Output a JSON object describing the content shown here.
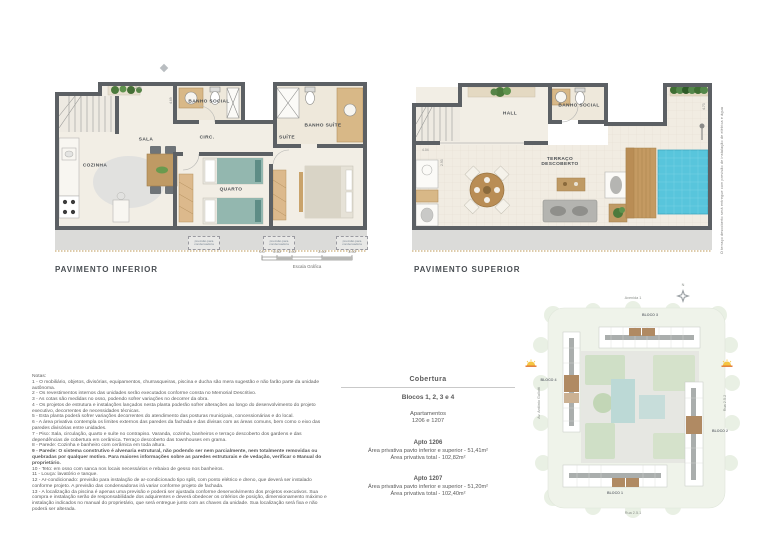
{
  "plans": {
    "inferior": {
      "title": "PAVIMENTO INFERIOR",
      "rooms": {
        "cozinha": "COZINHA",
        "sala": "SALA",
        "circ": "CIRC.",
        "banho_social": "BANHO SOCIAL",
        "suite": "SUÍTE",
        "banho_suite": "BANHO SUÍTE",
        "quarto": "QUARTO"
      },
      "condenser_label": "previsão para condensadora",
      "dims": {
        "top": "2.44",
        "right_of_stairs": "4.69"
      }
    },
    "superior": {
      "title": "PAVIMENTO SUPERIOR",
      "rooms": {
        "hall": "HALL",
        "banho_social": "BANHO SOCIAL",
        "terraco": "TERRAÇO DESCOBERTO"
      },
      "dims": {
        "stairs_width": "4.04",
        "stairs_depth": "2.93",
        "terrace_right": "4.73"
      },
      "side_note": "O terraço descoberto será entregue com previsão de instalação de elétrica e água"
    },
    "scale_bar": {
      "ticks": [
        "0.0",
        "0.50",
        "1.00",
        "2.00",
        "3.00"
      ],
      "label": "Escala Gráfica"
    }
  },
  "notes": {
    "heading": "Notas:",
    "items": [
      "1 - O mobiliário, objetos, divisórias, equipamentos, churrasqueiras, piscina e ducha são mera sugestão e não farão parte da unidade autônoma.",
      "2 - Os revestimentos internos das unidades serão executados conforme consta no Memorial Descritivo.",
      "3 - As cotas são medidas no osso, podendo sofrer variações no decorrer da obra.",
      "4 - Os projetos de estrutura e instalações lançados nesta planta poderão sofrer alterações ao longo do desenvolvimento do projeto executivo, decorrentes de necessidades técnicas.",
      "5 - Esta planta poderá sofrer variações decorrentes do atendimento das posturas municipais, concessionárias e do local.",
      "6 - A área privativa contempla os limites externos das paredes da fachada e das divisas com as áreas comuns, bem como o eixo das paredes divisórias entre unidades.",
      "7 - Piso: Sala, circulação, quarto e suíte no contrapiso. Varanda, cozinha, banheiros e terraço descoberto dos gardens e das dependências de cobertura em cerâmica. Terraço descoberto das townhouses em grama.",
      "8 - Parede: Cozinha e banheiro com cerâmica em toda altura.",
      "9 - Parede: O sistema construtivo é alvenaria estrutural, não podendo ser nem parcialmente, nem totalmente removidas ou quebradas por qualquer motivo. Para maiores informações sobre as paredes estruturais e de vedação, verificar o Manual do proprietário.",
      "10 - Teto: em osso com sanca nos locais necessários e rebaixo de gesso nos banheiros.",
      "11 - Louça: lavatório e tanque.",
      "12 - Ar-condicionado: previsão para instalação de ar-condicionado tipo split, com ponto elétrico e dreno, que deverá ser instalado conforme projeto. A previsão das condensadoras irá variar conforme projeto de fachada.",
      "13 - A localização da piscina é apenas uma previsão e poderá ser ajustada conforme desenvolvimento dos projetos executivos. Sua compra e instalação serão de responsabilidade dos adquirentes e deverá obedecer os critérios de posição, dimensionamento máximo e instalação indicados no manual do proprietário, que será entregue junto com as chaves da unidade. Sua localização será fixa e não poderá ser alterada."
    ]
  },
  "info": {
    "title": "Cobertura",
    "blocks": "Blocos 1, 2, 3 e 4",
    "apartments_label": "Apartamentos",
    "apartments_numbers": "1206 e 1207",
    "units": [
      {
        "name": "Apto 1206",
        "area_line": "Área privativa pavto inferior e superior - 51,41m²",
        "total_line": "Área privativa total - 102,82m²"
      },
      {
        "name": "Apto 1207",
        "area_line": "Área privativa pavto inferior e superior - 51,20m²",
        "total_line": "Área privativa total - 102,40m²"
      }
    ]
  },
  "siteplan": {
    "north": "N",
    "streets": {
      "top": "Avenida 1",
      "left": "Av. Antônio Gallotti",
      "right": "Rua 2.5.2",
      "bottom": "Rua 2.5.1"
    },
    "blocks": {
      "b1": "BLOCO 1",
      "b2": "BLOCO 2",
      "b3": "BLOCO 3",
      "b4": "BLOCO 4"
    }
  },
  "colors": {
    "wall": "#5c6064",
    "floor": "#f2eee5",
    "pool": "#58c5dc",
    "deck": "#c49a62",
    "wood": "#bf9a64",
    "bed_teal": "#93b7af",
    "site_green": "#eff3ea",
    "highlight_unit": "#b08a63",
    "sun_yellow": "#f5c542",
    "sun_orange": "#e2762d"
  }
}
